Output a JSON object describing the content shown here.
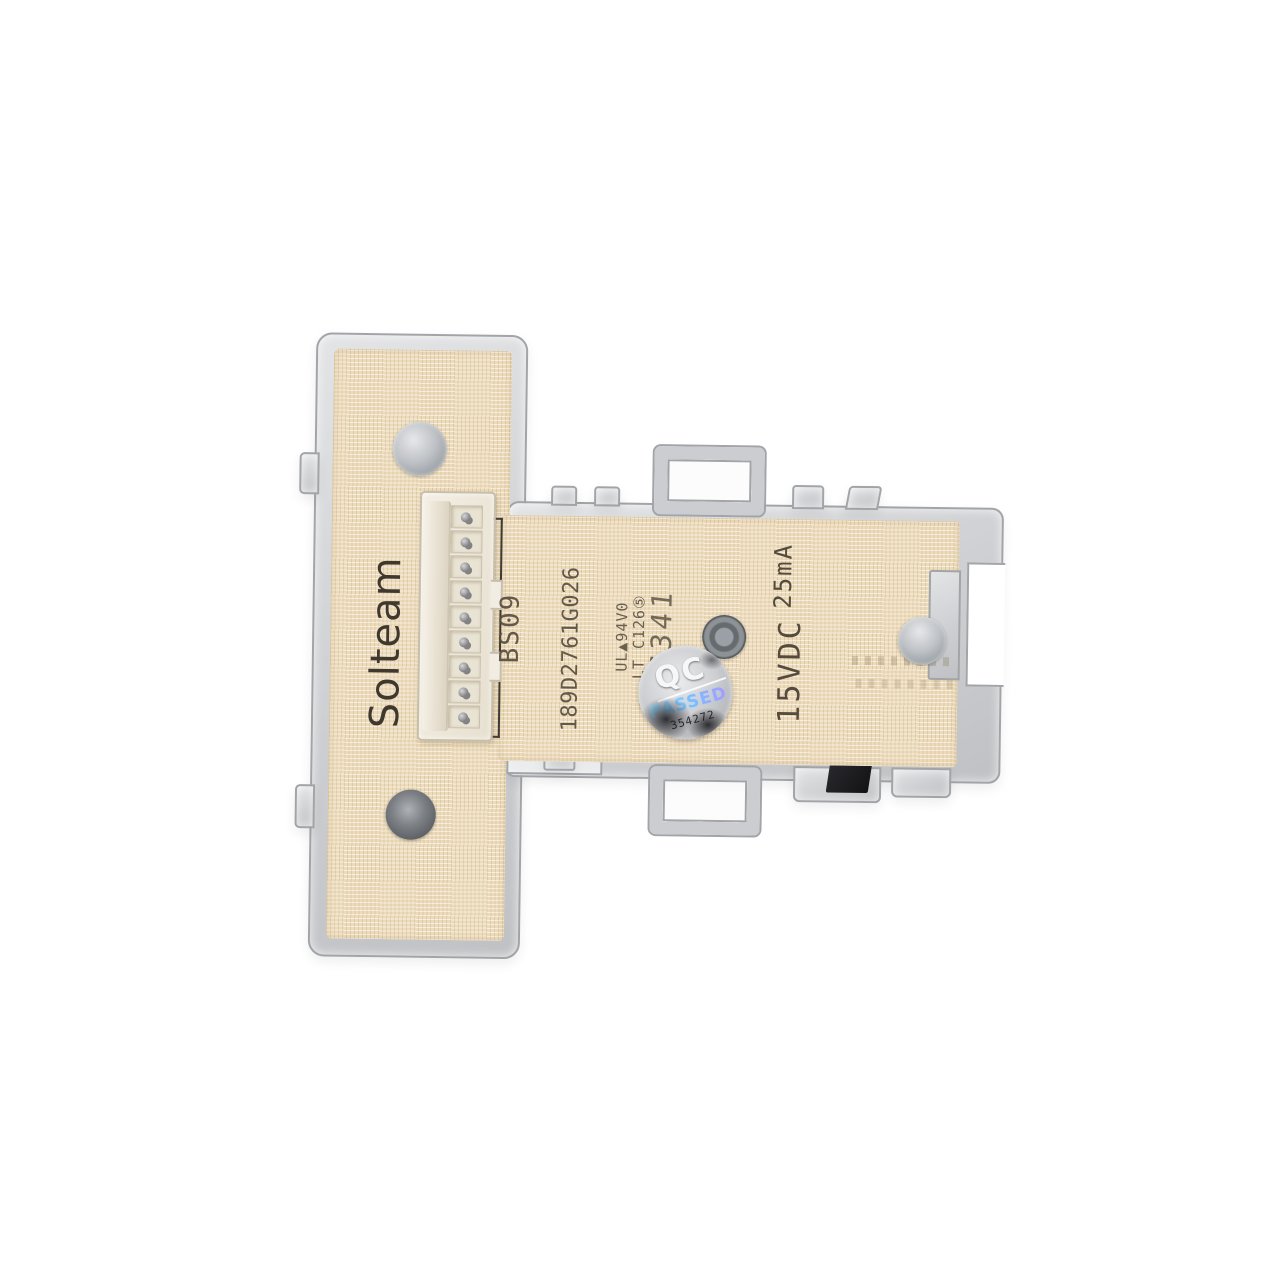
{
  "photo": {
    "subject": "Solteam washer control board in clear plastic housing",
    "board": {
      "brand": "Solteam",
      "model": "BS09",
      "part_number": "189D2761G026",
      "small_print_line1": "UL▲94V0",
      "small_print_line2": "LT C126⑤",
      "date_stamp": "16341",
      "voltage": "15VDC",
      "current": "25mA"
    },
    "qc_sticker": {
      "title": "QC",
      "status": "PASSED",
      "serial": "354272"
    },
    "colors": {
      "background": "#ffffff",
      "pcb": "#eddcbc",
      "pcb_grid": "#c7a97c",
      "plastic": "#cdcfd2",
      "plastic_edge": "#a2a4a8",
      "marking_text": "#544b3d",
      "connector": "#f2ede2",
      "sticker_silver": "#cfd0d3",
      "passed_holographic": "#86d8ff"
    }
  }
}
